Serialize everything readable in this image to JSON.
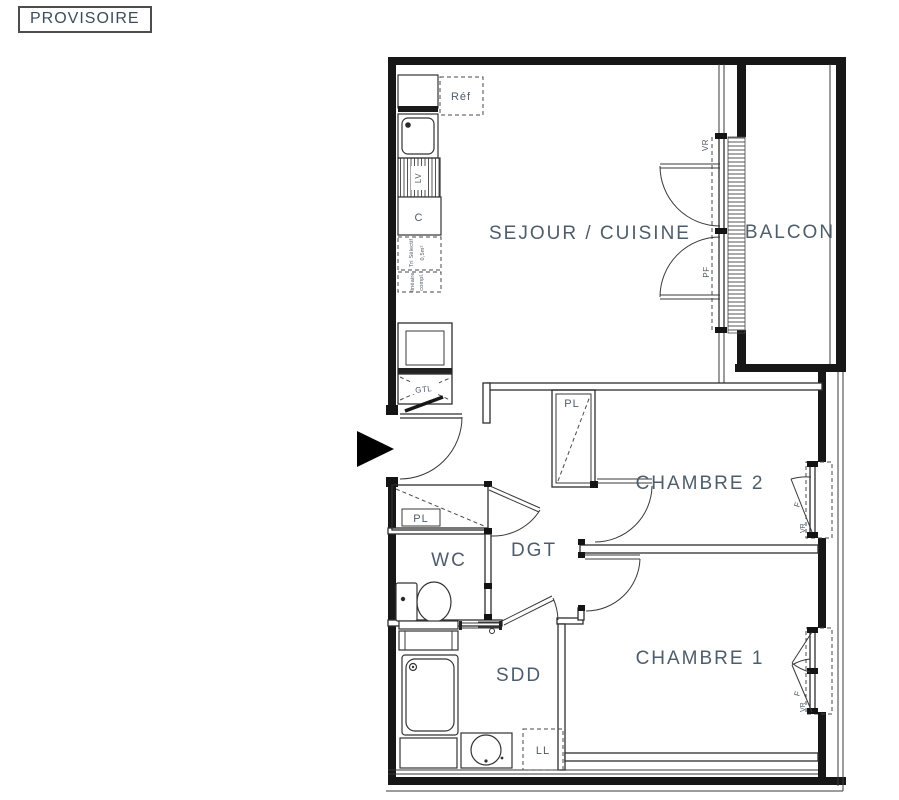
{
  "stamp": {
    "label": "PROVISOIRE"
  },
  "colors": {
    "wall": "#171717",
    "thin_line": "#383838",
    "label": "#4e5d6b"
  },
  "rooms": {
    "sejour_cuisine": {
      "label": "SEJOUR / CUISINE"
    },
    "balcon": {
      "label": "BALCON"
    },
    "chambre2": {
      "label": "CHAMBRE 2"
    },
    "chambre1": {
      "label": "CHAMBRE 1"
    },
    "wc": {
      "label": "WC"
    },
    "dgt": {
      "label": "DGT"
    },
    "sdd": {
      "label": "SDD"
    }
  },
  "annotations": {
    "refrigerator": "Réf",
    "dishwasher": "LV",
    "cooker": "C",
    "tri_selectif_line1": "Tri Sélectif",
    "tri_selectif_line2": "0,5m²",
    "lineaire_line1": "linéaire",
    "lineaire_line2": "compl.",
    "gtl": "GTL",
    "placard_wc": "PL",
    "placard_chambre2": "PL",
    "lave_linge": "LL",
    "volet_roulant_sejour": "VR",
    "porte_fenetre": "PF",
    "fenetre_chambre2": "F",
    "volet_roulant_chambre2": "VR",
    "fenetre_chambre1": "F",
    "volet_roulant_chambre1": "VR"
  }
}
